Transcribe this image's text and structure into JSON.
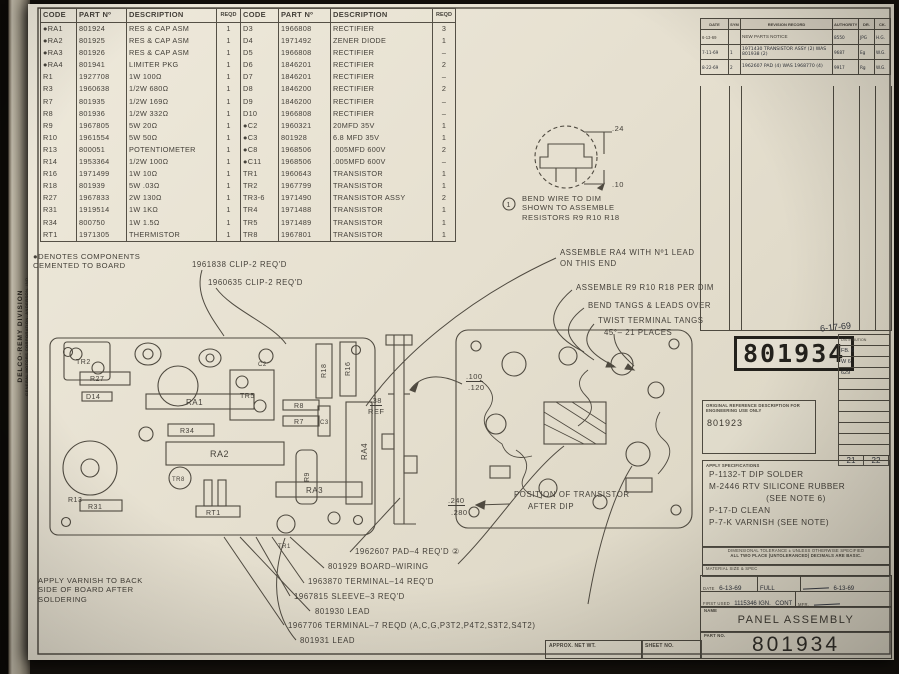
{
  "drawing": {
    "division": "DELCO-REMY DIVISION",
    "company": "GENERAL MOTORS CORPORATION, ANDERSON, IND.",
    "sheet_title": "PANEL ASSEMBLY",
    "part_number": "801934"
  },
  "tables": {
    "left": {
      "headers": [
        "CODE",
        "PART Nº",
        "DESCRIPTION",
        "REQD"
      ],
      "rows": [
        [
          "●RA1",
          "801924",
          "RES & CAP ASM",
          "1"
        ],
        [
          "●RA2",
          "801925",
          "RES & CAP ASM",
          "1"
        ],
        [
          "●RA3",
          "801926",
          "RES & CAP ASM",
          "1"
        ],
        [
          "●RA4",
          "801941",
          "LIMITER PKG",
          "1"
        ],
        [
          "R1",
          "1927708",
          "1W 100Ω",
          "1"
        ],
        [
          "R3",
          "1960638",
          "1/2W 680Ω",
          "1"
        ],
        [
          "R7",
          "801935",
          "1/2W 169Ω",
          "1"
        ],
        [
          "R8",
          "801936",
          "1/2W 332Ω",
          "1"
        ],
        [
          "R9",
          "1967805",
          "5W 20Ω",
          "1"
        ],
        [
          "R10",
          "1961554",
          "5W 50Ω",
          "1"
        ],
        [
          "R13",
          "800051",
          "POTENTIOMETER",
          "1"
        ],
        [
          "R14",
          "1953364",
          "1/2W 100Ω",
          "1"
        ],
        [
          "R16",
          "1971499",
          "1W 10Ω",
          "1"
        ],
        [
          "R18",
          "801939",
          "5W .03Ω",
          "1"
        ],
        [
          "R27",
          "1967833",
          "2W 130Ω",
          "1"
        ],
        [
          "R31",
          "1919514",
          "1W 1KΩ",
          "1"
        ],
        [
          "R34",
          "800750",
          "1W 1.5Ω",
          "1"
        ],
        [
          "RT1",
          "1971305",
          "THERMISTOR",
          "1"
        ]
      ]
    },
    "right": {
      "headers": [
        "CODE",
        "PART Nº",
        "DESCRIPTION",
        "REQD"
      ],
      "rows": [
        [
          "D3",
          "1966808",
          "RECTIFIER",
          "3"
        ],
        [
          "D4",
          "1971492",
          "ZENER DIODE",
          "1"
        ],
        [
          "D5",
          "1966808",
          "RECTIFIER",
          "–"
        ],
        [
          "D6",
          "1846201",
          "RECTIFIER",
          "2"
        ],
        [
          "D7",
          "1846201",
          "RECTIFIER",
          "–"
        ],
        [
          "D8",
          "1846200",
          "RECTIFIER",
          "2"
        ],
        [
          "D9",
          "1846200",
          "RECTIFIER",
          "–"
        ],
        [
          "D10",
          "1966808",
          "RECTIFIER",
          "–"
        ],
        [
          "●C2",
          "1960321",
          "20MFD 35V",
          "1"
        ],
        [
          "●C3",
          "801928",
          "6.8 MFD 35V",
          "1"
        ],
        [
          "●C8",
          "1968506",
          ".005MFD 600V",
          "2"
        ],
        [
          "●C11",
          "1968506",
          ".005MFD 600V",
          "–"
        ],
        [
          "TR1",
          "1960643",
          "TRANSISTOR",
          "1"
        ],
        [
          "TR2",
          "1967799",
          "TRANSISTOR",
          "1"
        ],
        [
          "TR3-6",
          "1971490",
          "TRANSISTOR ASSY",
          "2"
        ],
        [
          "TR4",
          "1971488",
          "TRANSISTOR",
          "1"
        ],
        [
          "TR5",
          "1971489",
          "TRANSISTOR",
          "1"
        ],
        [
          "TR8",
          "1967801",
          "TRANSISTOR",
          "1"
        ]
      ]
    },
    "footnote_marker": "①"
  },
  "notes": {
    "cemented_1": "●DENOTES COMPONENTS",
    "cemented_2": "CEMENTED TO BOARD",
    "varnish_1": "APPLY VARNISH TO BACK",
    "varnish_2": "SIDE OF BOARD AFTER",
    "varnish_3": "SOLDERING"
  },
  "bend_detail": {
    "dim_top": ".24",
    "dim_bottom": ".10",
    "caption_1": "BEND WIRE TO DIM",
    "caption_2": "SHOWN TO ASSEMBLE",
    "caption_3": "RESISTORS R9 R10 R18"
  },
  "annotations": {
    "clip1": "1961838 CLIP-2 REQ'D",
    "clip2": "1960635 CLIP-2 REQ'D",
    "assemble_ra4_1": "ASSEMBLE RA4 WITH Nº1 LEAD",
    "assemble_ra4_2": "ON THIS END",
    "assemble_r": "ASSEMBLE R9 R10 R18 PER DIM",
    "bend_tangs": "BEND TANGS & LEADS OVER",
    "twist_1": "TWIST TERMINAL TANGS",
    "twist_2": "45°– 21 PLACES",
    "position_1": "POSITION OF TRANSISTOR",
    "position_2": "AFTER DIP",
    "pad": "1962607 PAD–4 REQ'D ②",
    "board_wiring": "801929  BOARD–WIRING",
    "terminal14": "1963870 TERMINAL–14 REQ'D",
    "sleeve": "1967815 SLEEVE–3 REQ'D",
    "lead1": "801930  LEAD",
    "terminal7": "1967706 TERMINAL–7 REQD (A,C,G,P3T2,P4T2,S3T2,S4T2)",
    "lead2": "801931  LEAD"
  },
  "dims": {
    "gap_top": ".100",
    "gap_bottom": ".120",
    "ref": ".38",
    "ref_label": "REF",
    "dip_top": ".240",
    "dip_bottom": ".280"
  },
  "board": {
    "left_labels": [
      "TR2",
      "R27",
      "D14",
      "RA1",
      "TR5",
      "R8",
      "R7",
      "R18",
      "R16",
      "C3",
      "RA4",
      "R34",
      "RA2",
      "R9",
      "R13",
      "TR8",
      "R31",
      "RT1",
      "RA3",
      "TR1",
      "C2"
    ]
  },
  "revision_table": {
    "headers": [
      "DATE",
      "SYM",
      "REVISION RECORD",
      "AUTHORITY",
      "DR.",
      "CK."
    ],
    "rows": [
      [
        "6-13-69",
        "",
        "NEW PARTS NOTICE",
        "8550",
        "JPG",
        "H.G."
      ],
      [
        "7-11-69",
        "1",
        "1971430 TRANSISTOR ASSY (2) WAS 801938 (2)",
        "9687",
        "Eg",
        "W.G."
      ],
      [
        "8-22-69",
        "2",
        "1962607 PAD (4) WAS 1968770 (4)",
        "9917",
        "Rg",
        "W.G."
      ]
    ]
  },
  "title_block": {
    "stamp_number": "801934",
    "stamp_date": "6-17-69",
    "distribution_label": "DISTRIBUTION",
    "dist_row1": "FB.  6",
    "dist_row2": "W   6",
    "dist_row3": "629",
    "page_left": "21",
    "page_right": "22",
    "original_ref_label_1": "ORIGINAL REFERENCE DESCRIPTION FOR",
    "original_ref_label_2": "ENGINEERING USE ONLY",
    "original_ref_value": "801923",
    "apply_specs_label": "APPLY SPECIFICATIONS",
    "spec1": "P-1132-T DIP SOLDER",
    "spec2": "M-2446 RTV SILICONE RUBBER",
    "spec3": "(SEE NOTE 6)",
    "spec4": "P-17-D CLEAN",
    "spec5": "P-7-K VARNISH (SEE NOTE)",
    "tolerance_1": "DIMENSIONAL TOLERANCE ±      UNLESS OTHERWISE SPECIFIED",
    "tolerance_2": "ALL TWO PLACE (UNTOLERANCED) DECIMALS ARE BASIC.",
    "material_label": "MATERIAL SIZE & SPEC",
    "date_label": "DATE",
    "date_value": "6-13-69",
    "scale_value": "FULL",
    "approved_date": "6-13-69",
    "first_used_label": "FIRST USED",
    "first_used_value": "1115346  IGN.",
    "first_used_value2": "CONT",
    "mfr_label": "MFR.",
    "name_label": "NAME",
    "part_label": "PART NO.",
    "approx_wt_label": "APPROX. NET WT.",
    "sheet_no_label": "SHEET NO."
  }
}
